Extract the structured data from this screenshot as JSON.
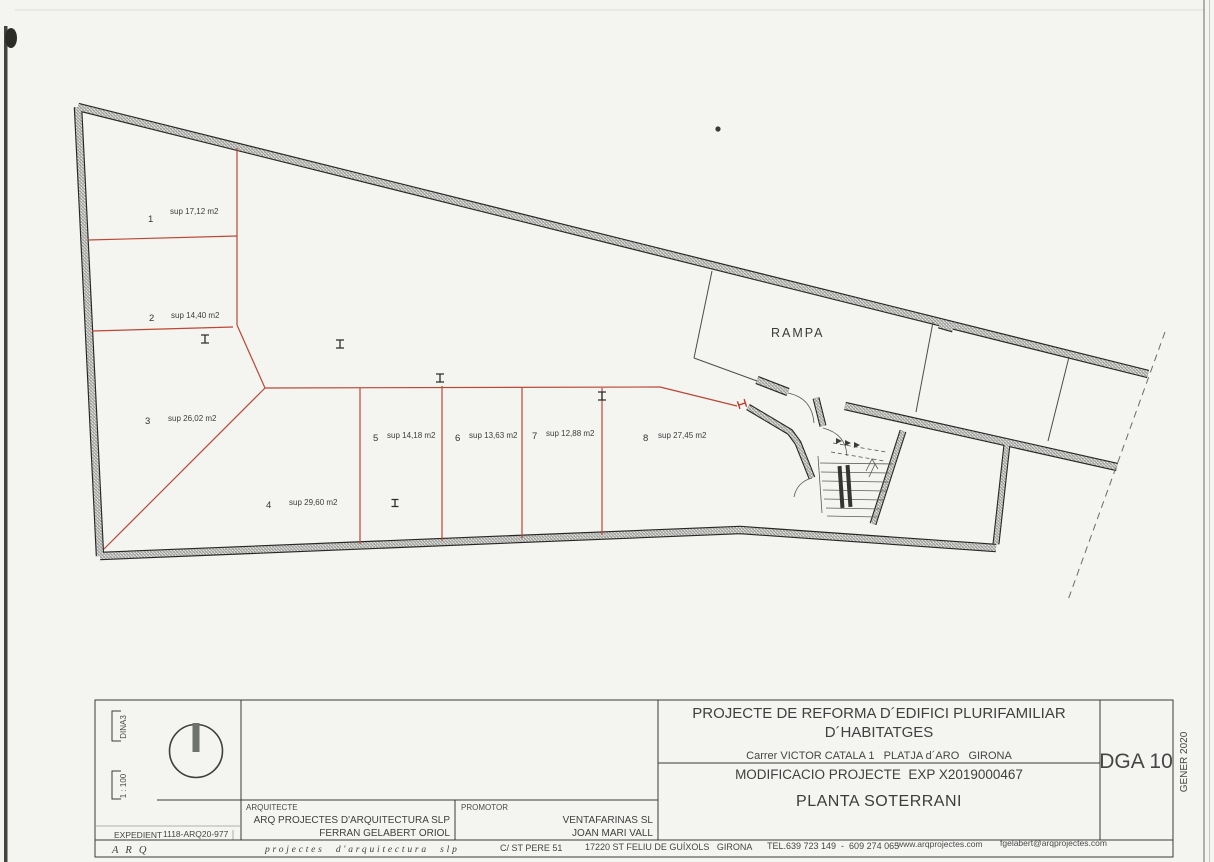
{
  "plan": {
    "ramp_label": "RAMPA",
    "spaces": [
      {
        "num": "1",
        "area": "sup 17,12 m2"
      },
      {
        "num": "2",
        "area": "sup 14,40 m2"
      },
      {
        "num": "3",
        "area": "sup 26,02 m2"
      },
      {
        "num": "4",
        "area": "sup 29,60 m2"
      },
      {
        "num": "5",
        "area": "sup 14,18 m2"
      },
      {
        "num": "6",
        "area": "sup 13,63 m2"
      },
      {
        "num": "7",
        "area": "sup 12,88 m2"
      },
      {
        "num": "8",
        "area": "sup 27,45 m2"
      }
    ]
  },
  "titleblock": {
    "project_title_line1": "PROJECTE DE REFORMA D´EDIFICI PLURIFAMILIAR",
    "project_title_line2": "D´HABITATGES",
    "address_line": "Carrer VICTOR CATALA 1   PLATJA d´ARO   GIRONA",
    "modification_line": "MODIFICACIO PROJECTE  EXP X2019000467",
    "sheet_title": "PLANTA SOTERRANI",
    "drawing_number": "DGA 10",
    "date": "GENER 2020",
    "paper_size": "DINA3",
    "scale": "1 : 100",
    "expedient_label": "EXPEDIENT",
    "expedient_number": "1118-ARQ20-977",
    "architect_label": "ARQUITECTE",
    "architect_firm": "ARQ PROJECTES D'ARQUITECTURA SLP",
    "architect_name": "FERRAN GELABERT ORIOL",
    "promoter_label": "PROMOTOR",
    "promoter_firm": "VENTAFARINAS SL",
    "promoter_name": "JOAN MARI VALL"
  },
  "footer": {
    "firm_acronym": "ARQ",
    "firm_name": "projectes d'arquitectura slp",
    "street": "C/ ST PERE 51",
    "city": "17220 ST FELIU DE GUÍXOLS   GIRONA",
    "phone": "TEL.639 723 149  -  609 274 065",
    "website": "www.arqprojectes.com",
    "email": "fgelabert@arqprojectes.com"
  },
  "colors": {
    "space_line_red": "#bc4733",
    "wall_ink": "#262624",
    "paper": "#f4f4f1"
  }
}
